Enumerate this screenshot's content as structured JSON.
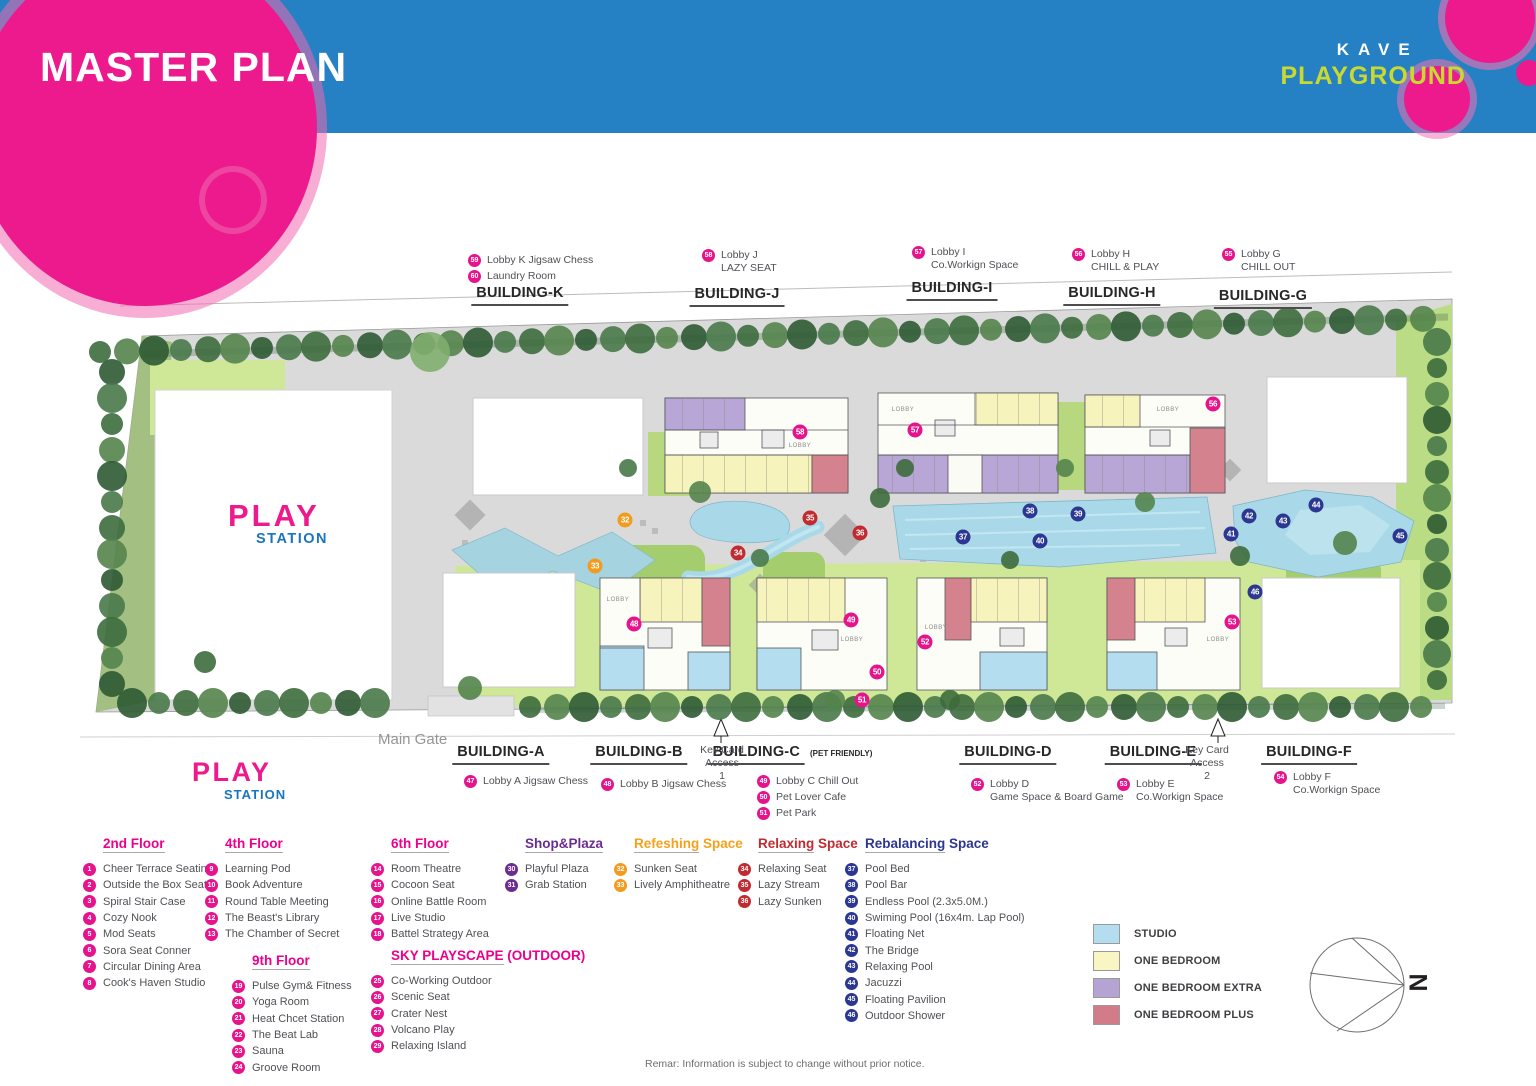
{
  "header": {
    "title": "MASTER PLAN",
    "brand_top": "KAVE",
    "brand_bottom": "PLAYGROUND"
  },
  "map": {
    "play1": "PLAY",
    "play2": "STATION",
    "main_gate": "Main Gate",
    "north": "N",
    "lobby_label": "LOBBY",
    "lobbies": [
      {
        "x": 800,
        "y": 446
      },
      {
        "x": 903,
        "y": 410
      },
      {
        "x": 1168,
        "y": 410
      },
      {
        "x": 618,
        "y": 600
      },
      {
        "x": 852,
        "y": 640
      },
      {
        "x": 936,
        "y": 628
      },
      {
        "x": 1218,
        "y": 640
      }
    ],
    "keycards": [
      {
        "x": 722,
        "y": 744,
        "lines": [
          "Key Card",
          "Access",
          "1"
        ]
      },
      {
        "x": 1207,
        "y": 744,
        "lines": [
          "Key Card",
          "Access",
          "2"
        ]
      }
    ]
  },
  "top_buildings": [
    {
      "label": "BUILDING-K",
      "suffix": "",
      "cx": 520,
      "ly": 285,
      "nx": 468,
      "ny": 254,
      "notes": [
        {
          "n": "59",
          "lines": [
            "Lobby K Jigsaw Chess"
          ]
        },
        {
          "n": "60",
          "lines": [
            "Laundry Room"
          ]
        }
      ]
    },
    {
      "label": "BUILDING-J",
      "suffix": "",
      "cx": 737,
      "ly": 286,
      "nx": 702,
      "ny": 249,
      "notes": [
        {
          "n": "58",
          "lines": [
            "Lobby J",
            "LAZY SEAT"
          ]
        }
      ]
    },
    {
      "label": "BUILDING-I",
      "suffix": "",
      "cx": 952,
      "ly": 280,
      "nx": 912,
      "ny": 246,
      "notes": [
        {
          "n": "57",
          "lines": [
            "Lobby I",
            "Co.Workign Space"
          ]
        }
      ]
    },
    {
      "label": "BUILDING-H",
      "suffix": "",
      "cx": 1112,
      "ly": 285,
      "nx": 1072,
      "ny": 248,
      "notes": [
        {
          "n": "56",
          "lines": [
            "Lobby H",
            "CHILL & PLAY"
          ]
        }
      ]
    },
    {
      "label": "BUILDING-G",
      "suffix": "",
      "cx": 1263,
      "ly": 288,
      "nx": 1222,
      "ny": 248,
      "notes": [
        {
          "n": "55",
          "lines": [
            "Lobby G",
            "CHILL OUT"
          ]
        }
      ]
    }
  ],
  "bottom_buildings": [
    {
      "label": "BUILDING-A",
      "suffix": "",
      "cx": 501,
      "ly": 744,
      "nx": 464,
      "ny": 775,
      "notes": [
        {
          "n": "47",
          "lines": [
            "Lobby A Jigsaw Chess"
          ]
        }
      ]
    },
    {
      "label": "BUILDING-B",
      "suffix": "",
      "cx": 639,
      "ly": 744,
      "nx": 601,
      "ny": 778,
      "notes": [
        {
          "n": "48",
          "lines": [
            "Lobby B Jigsaw Chess"
          ]
        }
      ]
    },
    {
      "label": "BUILDING-C",
      "suffix": "(PET FRIENDLY)",
      "cx": 790,
      "ly": 744,
      "nx": 757,
      "ny": 775,
      "notes": [
        {
          "n": "49",
          "lines": [
            "Lobby C Chill Out"
          ]
        },
        {
          "n": "50",
          "lines": [
            "Pet Lover Cafe"
          ]
        },
        {
          "n": "51",
          "lines": [
            "Pet Park"
          ]
        }
      ]
    },
    {
      "label": "BUILDING-D",
      "suffix": "",
      "cx": 1008,
      "ly": 744,
      "nx": 971,
      "ny": 778,
      "notes": [
        {
          "n": "52",
          "lines": [
            "Lobby D",
            "Game Space & Board Game"
          ]
        }
      ]
    },
    {
      "label": "BUILDING-E",
      "suffix": "",
      "cx": 1153,
      "ly": 744,
      "nx": 1117,
      "ny": 778,
      "notes": [
        {
          "n": "53",
          "lines": [
            "Lobby E",
            "Co.Workign Space"
          ]
        }
      ]
    },
    {
      "label": "BUILDING-F",
      "suffix": "",
      "cx": 1309,
      "ly": 744,
      "nx": 1274,
      "ny": 771,
      "notes": [
        {
          "n": "54",
          "lines": [
            "Lobby F",
            "Co.Workign Space"
          ]
        }
      ]
    }
  ],
  "legend_sections": [
    {
      "title_u": "2nd Floor",
      "title_rest": "",
      "theme": "pink",
      "x": 83,
      "y": 836,
      "items": [
        {
          "n": "1",
          "label": "Cheer Terrace Seating"
        },
        {
          "n": "2",
          "label": "Outside the Box Seat"
        },
        {
          "n": "3",
          "label": "Spiral Stair Case"
        },
        {
          "n": "4",
          "label": "Cozy Nook"
        },
        {
          "n": "5",
          "label": "Mod Seats"
        },
        {
          "n": "6",
          "label": "Sora Seat Conner"
        },
        {
          "n": "7",
          "label": "Circular Dining Area"
        },
        {
          "n": "8",
          "label": "Cook's Haven Studio"
        }
      ]
    },
    {
      "title_u": "4th Floor",
      "title_rest": "",
      "theme": "pink",
      "x": 205,
      "y": 836,
      "items": [
        {
          "n": "9",
          "label": "Learning Pod"
        },
        {
          "n": "10",
          "label": "Book Adventure"
        },
        {
          "n": "11",
          "label": "Round Table Meeting"
        },
        {
          "n": "12",
          "label": "The Beast's Library"
        },
        {
          "n": "13",
          "label": "The Chamber of Secret"
        }
      ]
    },
    {
      "title_u": "9th Floor",
      "title_rest": "",
      "theme": "pink",
      "x": 232,
      "y": 953,
      "items": [
        {
          "n": "19",
          "label": "Pulse Gym& Fitness"
        },
        {
          "n": "20",
          "label": "Yoga Room"
        },
        {
          "n": "21",
          "label": "Heat Chcet Station"
        },
        {
          "n": "22",
          "label": "The Beat Lab"
        },
        {
          "n": "23",
          "label": "Sauna"
        },
        {
          "n": "24",
          "label": "Groove Room"
        }
      ]
    },
    {
      "title_u": "6th Floor",
      "title_rest": "",
      "theme": "pink",
      "x": 371,
      "y": 836,
      "items": [
        {
          "n": "14",
          "label": "Room Theatre"
        },
        {
          "n": "15",
          "label": "Cocoon Seat"
        },
        {
          "n": "16",
          "label": "Online Battle Room"
        },
        {
          "n": "17",
          "label": "Live Studio"
        },
        {
          "n": "18",
          "label": "Battel Strategy Area"
        }
      ]
    },
    {
      "title_u": "SKY PLAYSCAPE",
      "title_rest": " (OUTDOOR)",
      "theme": "pink",
      "x": 371,
      "y": 948,
      "items": [
        {
          "n": "25",
          "label": "Co-Working Outdoor"
        },
        {
          "n": "26",
          "label": "Scenic Seat"
        },
        {
          "n": "27",
          "label": "Crater Nest"
        },
        {
          "n": "28",
          "label": "Volcano Play"
        },
        {
          "n": "29",
          "label": "Relaxing Island"
        }
      ]
    },
    {
      "title_u": "Shop&Plaza",
      "title_rest": "",
      "theme": "purple",
      "x": 505,
      "y": 836,
      "items": [
        {
          "n": "30",
          "label": "Playful Plaza"
        },
        {
          "n": "31",
          "label": "Grab Station"
        }
      ]
    },
    {
      "title_u": "Refeshing",
      "title_rest": " Space",
      "theme": "orange",
      "x": 614,
      "y": 836,
      "items": [
        {
          "n": "32",
          "label": "Sunken Seat"
        },
        {
          "n": "33",
          "label": "Lively Amphitheatre"
        }
      ]
    },
    {
      "title_u": "Relaxing",
      "title_rest": " Space",
      "theme": "red",
      "x": 738,
      "y": 836,
      "items": [
        {
          "n": "34",
          "label": "Relaxing Seat"
        },
        {
          "n": "35",
          "label": "Lazy Stream"
        },
        {
          "n": "36",
          "label": "Lazy Sunken"
        }
      ]
    },
    {
      "title_u": "Rebalancing",
      "title_rest": " Space",
      "theme": "blue",
      "x": 845,
      "y": 836,
      "items": [
        {
          "n": "37",
          "label": "Pool Bed"
        },
        {
          "n": "38",
          "label": "Pool Bar"
        },
        {
          "n": "39",
          "label": "Endless Pool (2.3x5.0M.)"
        },
        {
          "n": "40",
          "label": "Swiming Pool (16x4m. Lap Pool)"
        },
        {
          "n": "41",
          "label": "Floating Net"
        },
        {
          "n": "42",
          "label": "The Bridge"
        },
        {
          "n": "43",
          "label": "Relaxing Pool"
        },
        {
          "n": "44",
          "label": "Jacuzzi"
        },
        {
          "n": "45",
          "label": "Floating Pavilion"
        },
        {
          "n": "46",
          "label": "Outdoor Shower"
        }
      ]
    }
  ],
  "unit_legend": [
    {
      "label": "STUDIO",
      "color": "#b5ddf0"
    },
    {
      "label": "ONE BEDROOM",
      "color": "#f9f6c3"
    },
    {
      "label": "ONE BEDROOM EXTRA",
      "color": "#b4a3d3"
    },
    {
      "label": "ONE BEDROOM PLUS",
      "color": "#d17c88"
    }
  ],
  "map_markers": [
    {
      "n": "32",
      "c": "orange",
      "x": 625,
      "y": 520
    },
    {
      "n": "33",
      "c": "orange",
      "x": 595,
      "y": 566
    },
    {
      "n": "34",
      "c": "red",
      "x": 738,
      "y": 553
    },
    {
      "n": "35",
      "c": "red",
      "x": 810,
      "y": 518
    },
    {
      "n": "36",
      "c": "red",
      "x": 860,
      "y": 533
    },
    {
      "n": "37",
      "c": "blue",
      "x": 963,
      "y": 537
    },
    {
      "n": "38",
      "c": "blue",
      "x": 1030,
      "y": 511
    },
    {
      "n": "39",
      "c": "blue",
      "x": 1078,
      "y": 514
    },
    {
      "n": "40",
      "c": "blue",
      "x": 1040,
      "y": 541
    },
    {
      "n": "41",
      "c": "blue",
      "x": 1231,
      "y": 534
    },
    {
      "n": "42",
      "c": "blue",
      "x": 1249,
      "y": 516
    },
    {
      "n": "43",
      "c": "blue",
      "x": 1283,
      "y": 521
    },
    {
      "n": "44",
      "c": "blue",
      "x": 1316,
      "y": 505
    },
    {
      "n": "45",
      "c": "blue",
      "x": 1400,
      "y": 536
    },
    {
      "n": "46",
      "c": "blue",
      "x": 1255,
      "y": 592
    },
    {
      "n": "48",
      "c": "pink",
      "x": 634,
      "y": 624
    },
    {
      "n": "49",
      "c": "pink",
      "x": 851,
      "y": 620
    },
    {
      "n": "50",
      "c": "pink",
      "x": 877,
      "y": 672
    },
    {
      "n": "51",
      "c": "pink",
      "x": 862,
      "y": 700
    },
    {
      "n": "52",
      "c": "pink",
      "x": 925,
      "y": 642
    },
    {
      "n": "53",
      "c": "pink",
      "x": 1232,
      "y": 622
    },
    {
      "n": "56",
      "c": "pink",
      "x": 1213,
      "y": 404
    },
    {
      "n": "57",
      "c": "pink",
      "x": 915,
      "y": 430
    },
    {
      "n": "58",
      "c": "pink",
      "x": 800,
      "y": 432
    }
  ],
  "note": "Remar: Information is subject to change without prior notice."
}
